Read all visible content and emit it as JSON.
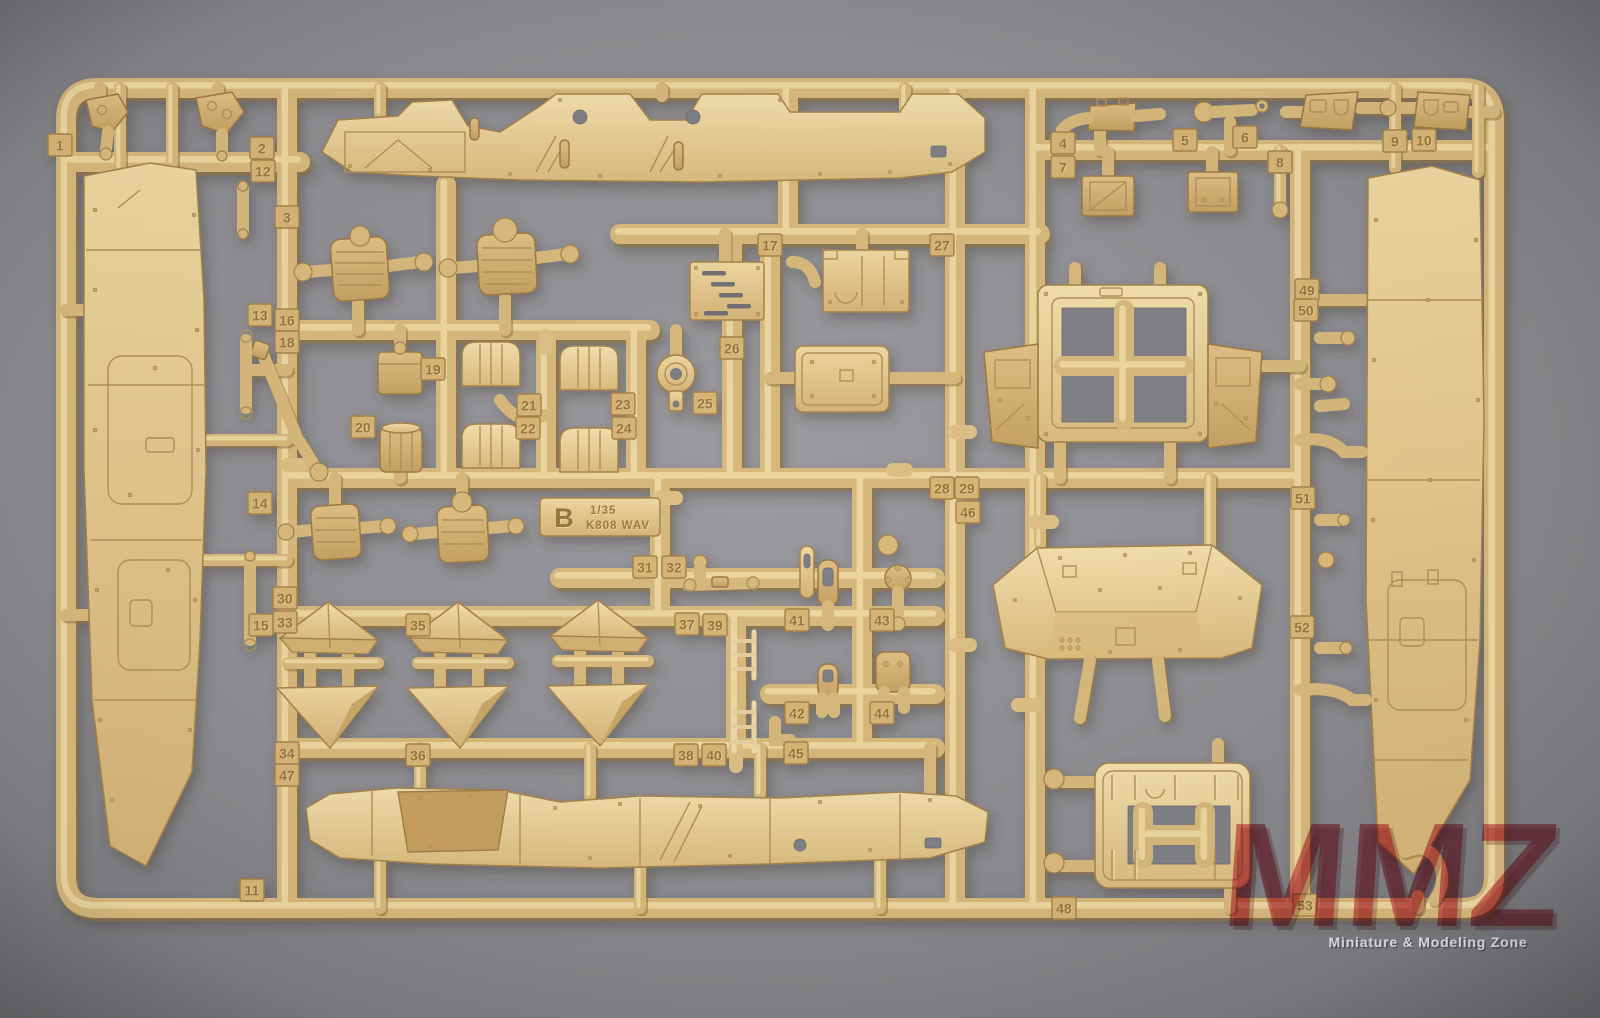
{
  "sprue": {
    "letter": "B",
    "scale": "1/35",
    "kit_name": "K808 WAV",
    "part_tabs": [
      {
        "n": "1",
        "x": 60,
        "y": 145
      },
      {
        "n": "2",
        "x": 262,
        "y": 148
      },
      {
        "n": "3",
        "x": 287,
        "y": 217
      },
      {
        "n": "4",
        "x": 1063,
        "y": 143
      },
      {
        "n": "5",
        "x": 1185,
        "y": 140
      },
      {
        "n": "6",
        "x": 1245,
        "y": 137
      },
      {
        "n": "7",
        "x": 1063,
        "y": 167
      },
      {
        "n": "8",
        "x": 1280,
        "y": 162
      },
      {
        "n": "9",
        "x": 1395,
        "y": 141
      },
      {
        "n": "10",
        "x": 1424,
        "y": 140
      },
      {
        "n": "11",
        "x": 252,
        "y": 890
      },
      {
        "n": "12",
        "x": 263,
        "y": 171
      },
      {
        "n": "13",
        "x": 260,
        "y": 315
      },
      {
        "n": "14",
        "x": 260,
        "y": 503
      },
      {
        "n": "15",
        "x": 261,
        "y": 625
      },
      {
        "n": "16",
        "x": 287,
        "y": 320
      },
      {
        "n": "17",
        "x": 770,
        "y": 245
      },
      {
        "n": "18",
        "x": 287,
        "y": 342
      },
      {
        "n": "19",
        "x": 433,
        "y": 369
      },
      {
        "n": "20",
        "x": 363,
        "y": 427
      },
      {
        "n": "21",
        "x": 529,
        "y": 405
      },
      {
        "n": "22",
        "x": 528,
        "y": 428
      },
      {
        "n": "23",
        "x": 623,
        "y": 404
      },
      {
        "n": "24",
        "x": 624,
        "y": 428
      },
      {
        "n": "25",
        "x": 705,
        "y": 403
      },
      {
        "n": "26",
        "x": 732,
        "y": 348
      },
      {
        "n": "27",
        "x": 942,
        "y": 245
      },
      {
        "n": "28",
        "x": 942,
        "y": 488
      },
      {
        "n": "29",
        "x": 967,
        "y": 488
      },
      {
        "n": "30",
        "x": 285,
        "y": 598
      },
      {
        "n": "31",
        "x": 645,
        "y": 567
      },
      {
        "n": "32",
        "x": 674,
        "y": 567
      },
      {
        "n": "33",
        "x": 285,
        "y": 622
      },
      {
        "n": "34",
        "x": 287,
        "y": 753
      },
      {
        "n": "35",
        "x": 418,
        "y": 625
      },
      {
        "n": "36",
        "x": 418,
        "y": 755
      },
      {
        "n": "37",
        "x": 687,
        "y": 624
      },
      {
        "n": "38",
        "x": 686,
        "y": 755
      },
      {
        "n": "39",
        "x": 715,
        "y": 625
      },
      {
        "n": "40",
        "x": 714,
        "y": 755
      },
      {
        "n": "41",
        "x": 797,
        "y": 620
      },
      {
        "n": "42",
        "x": 797,
        "y": 713
      },
      {
        "n": "43",
        "x": 882,
        "y": 620
      },
      {
        "n": "44",
        "x": 882,
        "y": 713
      },
      {
        "n": "45",
        "x": 796,
        "y": 753
      },
      {
        "n": "46",
        "x": 968,
        "y": 512
      },
      {
        "n": "47",
        "x": 287,
        "y": 775
      },
      {
        "n": "48",
        "x": 1064,
        "y": 908
      },
      {
        "n": "49",
        "x": 1307,
        "y": 290
      },
      {
        "n": "50",
        "x": 1306,
        "y": 310
      },
      {
        "n": "51",
        "x": 1303,
        "y": 498
      },
      {
        "n": "52",
        "x": 1302,
        "y": 627
      },
      {
        "n": "53",
        "x": 1305,
        "y": 905
      }
    ]
  },
  "watermark": {
    "logo": "MMZ",
    "tagline": "Miniature & Modeling Zone"
  },
  "colors": {
    "plastic": "#d7b87b",
    "plastic_highlight": "#f0dba6",
    "plastic_shadow": "#93743f",
    "background": "#8c8c90",
    "watermark_red": "#c8334e"
  }
}
